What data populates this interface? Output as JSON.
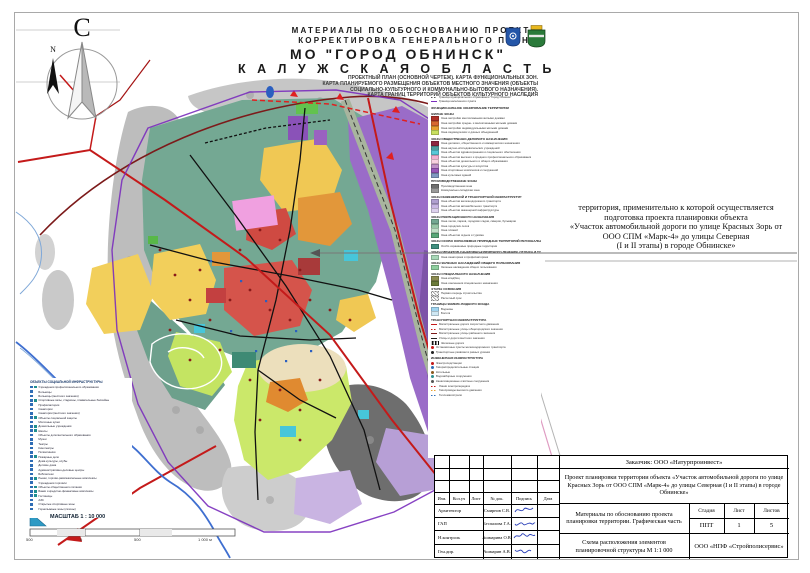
{
  "page": {
    "sheet_bg": "#ffffff",
    "frame_color": "#a9a9a9"
  },
  "compass": {
    "north_letter": "С",
    "small_arrow_label": "N"
  },
  "header": {
    "materials_line1": "МАТЕРИАЛЫ ПО ОБОСНОВАНИЮ ПРОЕКТА",
    "materials_line2": "КОРРЕКТИРОВКА ГЕНЕРАЛЬНОГО ПЛАНА",
    "municipality": "МО \"ГОРОД ОБНИНСК\"",
    "region": "К А Л У Ж С К А Я   О Б Л А С Т Ь",
    "subtitle_lines": [
      "ПРОЕКТНЫЙ ПЛАН (ОСНОВНОЙ ЧЕРТЕЖ). КАРТА ФУНКЦИОНАЛЬНЫХ ЗОН.",
      "КАРТА ПЛАНИРУЕМОГО РАЗМЕЩЕНИЯ ОБЪЕКТОВ МЕСТНОГО ЗНАЧЕНИЯ (ОБЪЕКТЫ",
      "СОЦИАЛЬНО-КУЛЬТУРНОГО И КОММУНАЛЬНО-БЫТОВОГО НАЗНАЧЕНИЯ).",
      "КАРТА ГРАНИЦ ТЕРРИТОРИЙ ОБЪЕКТОВ КУЛЬТУРНОГО НАСЛЕДИЯ"
    ],
    "emblems": [
      "obninsk-crest",
      "kaluga-oblast-crest"
    ]
  },
  "annotation": {
    "lines": [
      "территория, применительно к которой осуществляется",
      "подготовка проекта планировки объекта",
      "«Участок автомобильной дороги по улице Красных Зорь от",
      "ООО СПМ «Марк-4» до улицы Северная",
      "(I и II этапы) в городе Обнинске»"
    ]
  },
  "map": {
    "scale_label": "МАСШТАБ 1 : 10 000",
    "scale_ticks": [
      "500",
      "0",
      "500",
      "1 000 м"
    ],
    "accent_colors": {
      "planned_road": "#c41a1a",
      "boundary": "#7a2dbd",
      "river": "#3f6fd0",
      "railway": "#a8b49e"
    }
  },
  "zones_legend": {
    "sections": [
      {
        "header": "",
        "items": [
          {
            "color": "#555555",
            "label": "Граница муниципального образования \"Город Обнинск\"",
            "sym": "line-dash"
          },
          {
            "color": "#7a2dbd",
            "label": "Граница населенного пункта",
            "sym": "line"
          }
        ]
      },
      {
        "header": "ФУНКЦИОНАЛЬНОЕ ЗОНИРОВАНИЕ ТЕРРИТОРИИ",
        "items": []
      },
      {
        "header": "ЖИЛЫЕ ЗОНЫ",
        "items": [
          {
            "color": "#b03028",
            "label": "Зона застройки многоэтажными жилыми домами"
          },
          {
            "color": "#d86830",
            "label": "Зона застройки средне- и малоэтажными жилыми домами"
          },
          {
            "color": "#e8a030",
            "label": "Зона застройки индивидуальными жилыми домами"
          },
          {
            "color": "#c8e060",
            "label": "Зона садоводческих и дачных объединений"
          }
        ]
      },
      {
        "header": "ЗОНЫ ОБЩЕСТВЕННО-ДЕЛОВОГО НАЗНАЧЕНИЯ",
        "items": [
          {
            "color": "#8e2740",
            "label": "Зона делового, общественного и коммерческого назначения"
          },
          {
            "color": "#4f9e9e",
            "label": "Зона научно-исследовательских учреждений"
          },
          {
            "color": "#58c8d8",
            "label": "Зона объектов здравоохранения и социального обеспечения"
          },
          {
            "color": "#f0b0d0",
            "label": "Зона объектов высшего и среднего профессионального образования"
          },
          {
            "color": "#f8d0e0",
            "label": "Зона объектов дошкольного и общего образования"
          },
          {
            "color": "#c090c8",
            "label": "Зона объектов культуры и искусства"
          },
          {
            "color": "#9858b8",
            "label": "Зона спортивных комплексов и сооружений"
          },
          {
            "color": "#8098c0",
            "label": "Зона культовых зданий"
          }
        ]
      },
      {
        "header": "ПРОИЗВОДСТВЕННЫЕ ЗОНЫ",
        "items": [
          {
            "color": "#6e6e6e",
            "label": "Производственная зона"
          },
          {
            "color": "#9a9a9a",
            "label": "Коммунально-складская зона"
          }
        ]
      },
      {
        "header": "ЗОНЫ ИНЖЕНЕРНОЙ И ТРАНСПОРТНОЙ ИНФРАСТРУКТУР",
        "items": [
          {
            "color": "#b0a0d0",
            "label": "Зона объектов железнодорожного транспорта"
          },
          {
            "color": "#c9b7e4",
            "label": "Зона объектов автомобильного транспорта"
          },
          {
            "color": "#ddd1ee",
            "label": "Зона объектов инженерной инфраструктуры"
          }
        ]
      },
      {
        "header": "ЗОНЫ РЕКРЕАЦИОННОГО НАЗНАЧЕНИЯ",
        "items": [
          {
            "color": "#74a893",
            "label": "Зона лесов, парков, городских садов, скверов, бульваров"
          },
          {
            "color": "#98c8a8",
            "label": "Зона городских лесов"
          },
          {
            "color": "#c0e0c8",
            "label": "Зона пляжей"
          },
          {
            "color": "#58a878",
            "label": "Зона объектов отдыха и туризма"
          }
        ]
      },
      {
        "header": "ЗОНЫ ОСОБО ОХРАНЯЕМЫХ ПРИРОДНЫХ ТЕРРИТОРИЙ РЕГИОНАЛЬНОГО ЗНАЧЕНИЯ",
        "items": [
          {
            "color": "#3f8f7f",
            "label": "Особо охраняемые природные территории"
          }
        ]
      },
      {
        "header": "ЗОНЫ ОБЪЕКТОВ САНАТОРНО-КУРОРТНОГО ЛЕЧЕНИЯ, ОТДЫХА И ТУРИЗМА",
        "items": [
          {
            "color": "#a8d8b8",
            "label": "Зона санаториев и профилакториев"
          }
        ]
      },
      {
        "header": "ЗОНЫ ЗЕЛЕНЫХ НАСАЖДЕНИЙ ОБЩЕГО ПОЛЬЗОВАНИЯ",
        "items": [
          {
            "color": "#8fcf9f",
            "label": "Зеленые насаждения общего пользования"
          }
        ]
      },
      {
        "header": "ЗОНЫ СПЕЦИАЛЬНОГО НАЗНАЧЕНИЯ",
        "items": [
          {
            "color": "#8a8a50",
            "label": "Зона кладбищ"
          },
          {
            "color": "#6b7b3a",
            "label": "Зона озеленения специального назначения"
          }
        ]
      },
      {
        "header": "ЭТАПЫ ОСВОЕНИЯ",
        "items": [
          {
            "color": "#bbbbbb",
            "label": "Первая очередь строительства",
            "sym": "hatch"
          },
          {
            "color": "#dddddd",
            "label": "Расчетный срок",
            "sym": "hatch"
          }
        ]
      },
      {
        "header": "ГРАНИЦЫ ЗЕМЕЛЬ ВОДНОГО ФОНДА",
        "items": [
          {
            "color": "#9fd4f0",
            "label": "Водоемы"
          },
          {
            "color": "#cfe8f4",
            "label": "Болота"
          }
        ]
      },
      {
        "header": "ТРАНСПОРТНАЯ ИНФРАСТРУКТУРА",
        "items": [
          {
            "color": "#c41a1a",
            "label": "Магистральные дороги скоростного движения",
            "sym": "line"
          },
          {
            "color": "#c41a1a",
            "label": "Магистральные улицы общегородского значения",
            "sym": "line-dash"
          },
          {
            "color": "#7c1a1a",
            "label": "Магистральные улицы районного значения",
            "sym": "line"
          },
          {
            "color": "#222222",
            "label": "Улицы и дороги местного значения",
            "sym": "line"
          },
          {
            "color": "#222222",
            "label": "Железные дороги",
            "sym": "rail"
          },
          {
            "color": "#c41a1a",
            "label": "Остановочные пункты железнодорожного транспорта",
            "sym": "dot"
          },
          {
            "color": "#222222",
            "label": "Транспортные развязки в разных уровнях",
            "sym": "dot"
          }
        ]
      },
      {
        "header": "ИНЖЕНЕРНАЯ ИНФРАСТРУКТУРА",
        "items": [
          {
            "color": "#c41a1a",
            "label": "Электроподстанции",
            "sym": "dot"
          },
          {
            "color": "#2f6db5",
            "label": "Газораспределительные станции",
            "sym": "dot"
          },
          {
            "color": "#8a5a20",
            "label": "Котельные",
            "sym": "dot"
          },
          {
            "color": "#2f8f8f",
            "label": "Водозаборные сооружения",
            "sym": "dot"
          },
          {
            "color": "#555555",
            "label": "Канализационные очистные сооружения",
            "sym": "dot"
          },
          {
            "color": "#c41a1a",
            "label": "Линии электропередачи",
            "sym": "line-dash"
          },
          {
            "color": "#e8a030",
            "label": "Газопроводы высокого давления",
            "sym": "line-dash"
          },
          {
            "color": "#2f6db5",
            "label": "Тепломагистрали",
            "sym": "line-dash"
          }
        ]
      }
    ]
  },
  "social_legend": {
    "title": "ОБЪЕКТЫ СОЦИАЛЬНОЙ ИНФРАСТРУКТУРЫ",
    "items": [
      {
        "label": "Учреждения профессионального образования",
        "sq": 2
      },
      {
        "label": "Больницы",
        "sq": 1
      },
      {
        "label": "Больницы (местного значения)",
        "sq": 1
      },
      {
        "label": "Спортивные залы, стадионы, плавательные бассейны",
        "sq": 2
      },
      {
        "label": "Профилактории",
        "sq": 1
      },
      {
        "label": "Санатории",
        "sq": 1
      },
      {
        "label": "Санатории (местного значения)",
        "sq": 1
      },
      {
        "label": "Объекты социальной защиты",
        "sq": 2
      },
      {
        "label": "Молочные кухни",
        "sq": 1
      },
      {
        "label": "Дошкольные учреждения",
        "sq": 2
      },
      {
        "label": "Школы",
        "sq": 2
      },
      {
        "label": "Объекты дополнительного образования",
        "sq": 1
      },
      {
        "label": "Музеи",
        "sq": 1
      },
      {
        "label": "Театры",
        "sq": 1
      },
      {
        "label": "Кинотеатры",
        "sq": 1
      },
      {
        "label": "Поликлиники",
        "sq": 1
      },
      {
        "label": "Пожарные депо",
        "sq": 2
      },
      {
        "label": "Дома культуры, клубы",
        "sq": 1
      },
      {
        "label": "Детские дома",
        "sq": 1
      },
      {
        "label": "Административно-деловые центры",
        "sq": 1
      },
      {
        "label": "Библиотеки",
        "sq": 1
      },
      {
        "label": "Рынки, торгово-развлекательные комплексы",
        "sq": 2
      },
      {
        "label": "Учреждения торговли",
        "sq": 1
      },
      {
        "label": "Объекты общественного питания",
        "sq": 2
      },
      {
        "label": "Банки и кредитно-финансовые комплексы",
        "sq": 2
      },
      {
        "label": "Гостиницы",
        "sq": 2
      },
      {
        "label": "АЗС",
        "sq": 1
      },
      {
        "label": "Открытые спортивные зоны",
        "sq": 1
      },
      {
        "label": "Горнолыжные зоны (склоны)",
        "sq": 1
      }
    ]
  },
  "title_block": {
    "customer": "Заказчик: ООО «Натурпроинвест»",
    "project": "Проект планировки территории объекта «Участок автомобильной дороги по улице Красных Зорь от ООО СПМ «Марк-4» до улицы Северная (I и II этапы) в городе Обнинске»",
    "doc_title": "Материалы по обоснованию проекта планировки территории. Графическая часть",
    "sheet_title": "Схема расположения элементов планировочной структуры М 1:1 000",
    "org": "ООО «НПФ «Стройполисервис»",
    "stage_label": "Стадия",
    "sheet_label": "Лист",
    "sheets_label": "Листов",
    "stage": "ППТ",
    "sheet": "1",
    "sheets": "5",
    "header_cells": [
      "Изм.",
      "Кол.уч",
      "Лист",
      "№ док.",
      "Подпись",
      "Дата"
    ],
    "signers": [
      {
        "role": "Архитектор",
        "name": "Смирнов С.В."
      },
      {
        "role": "ГАП",
        "name": "Беспалова Г.А."
      },
      {
        "role": "Н.контроль",
        "name": "Ашмарина О.В."
      },
      {
        "role": "Ген.дир.",
        "name": "Ашмарин А.В."
      }
    ]
  }
}
